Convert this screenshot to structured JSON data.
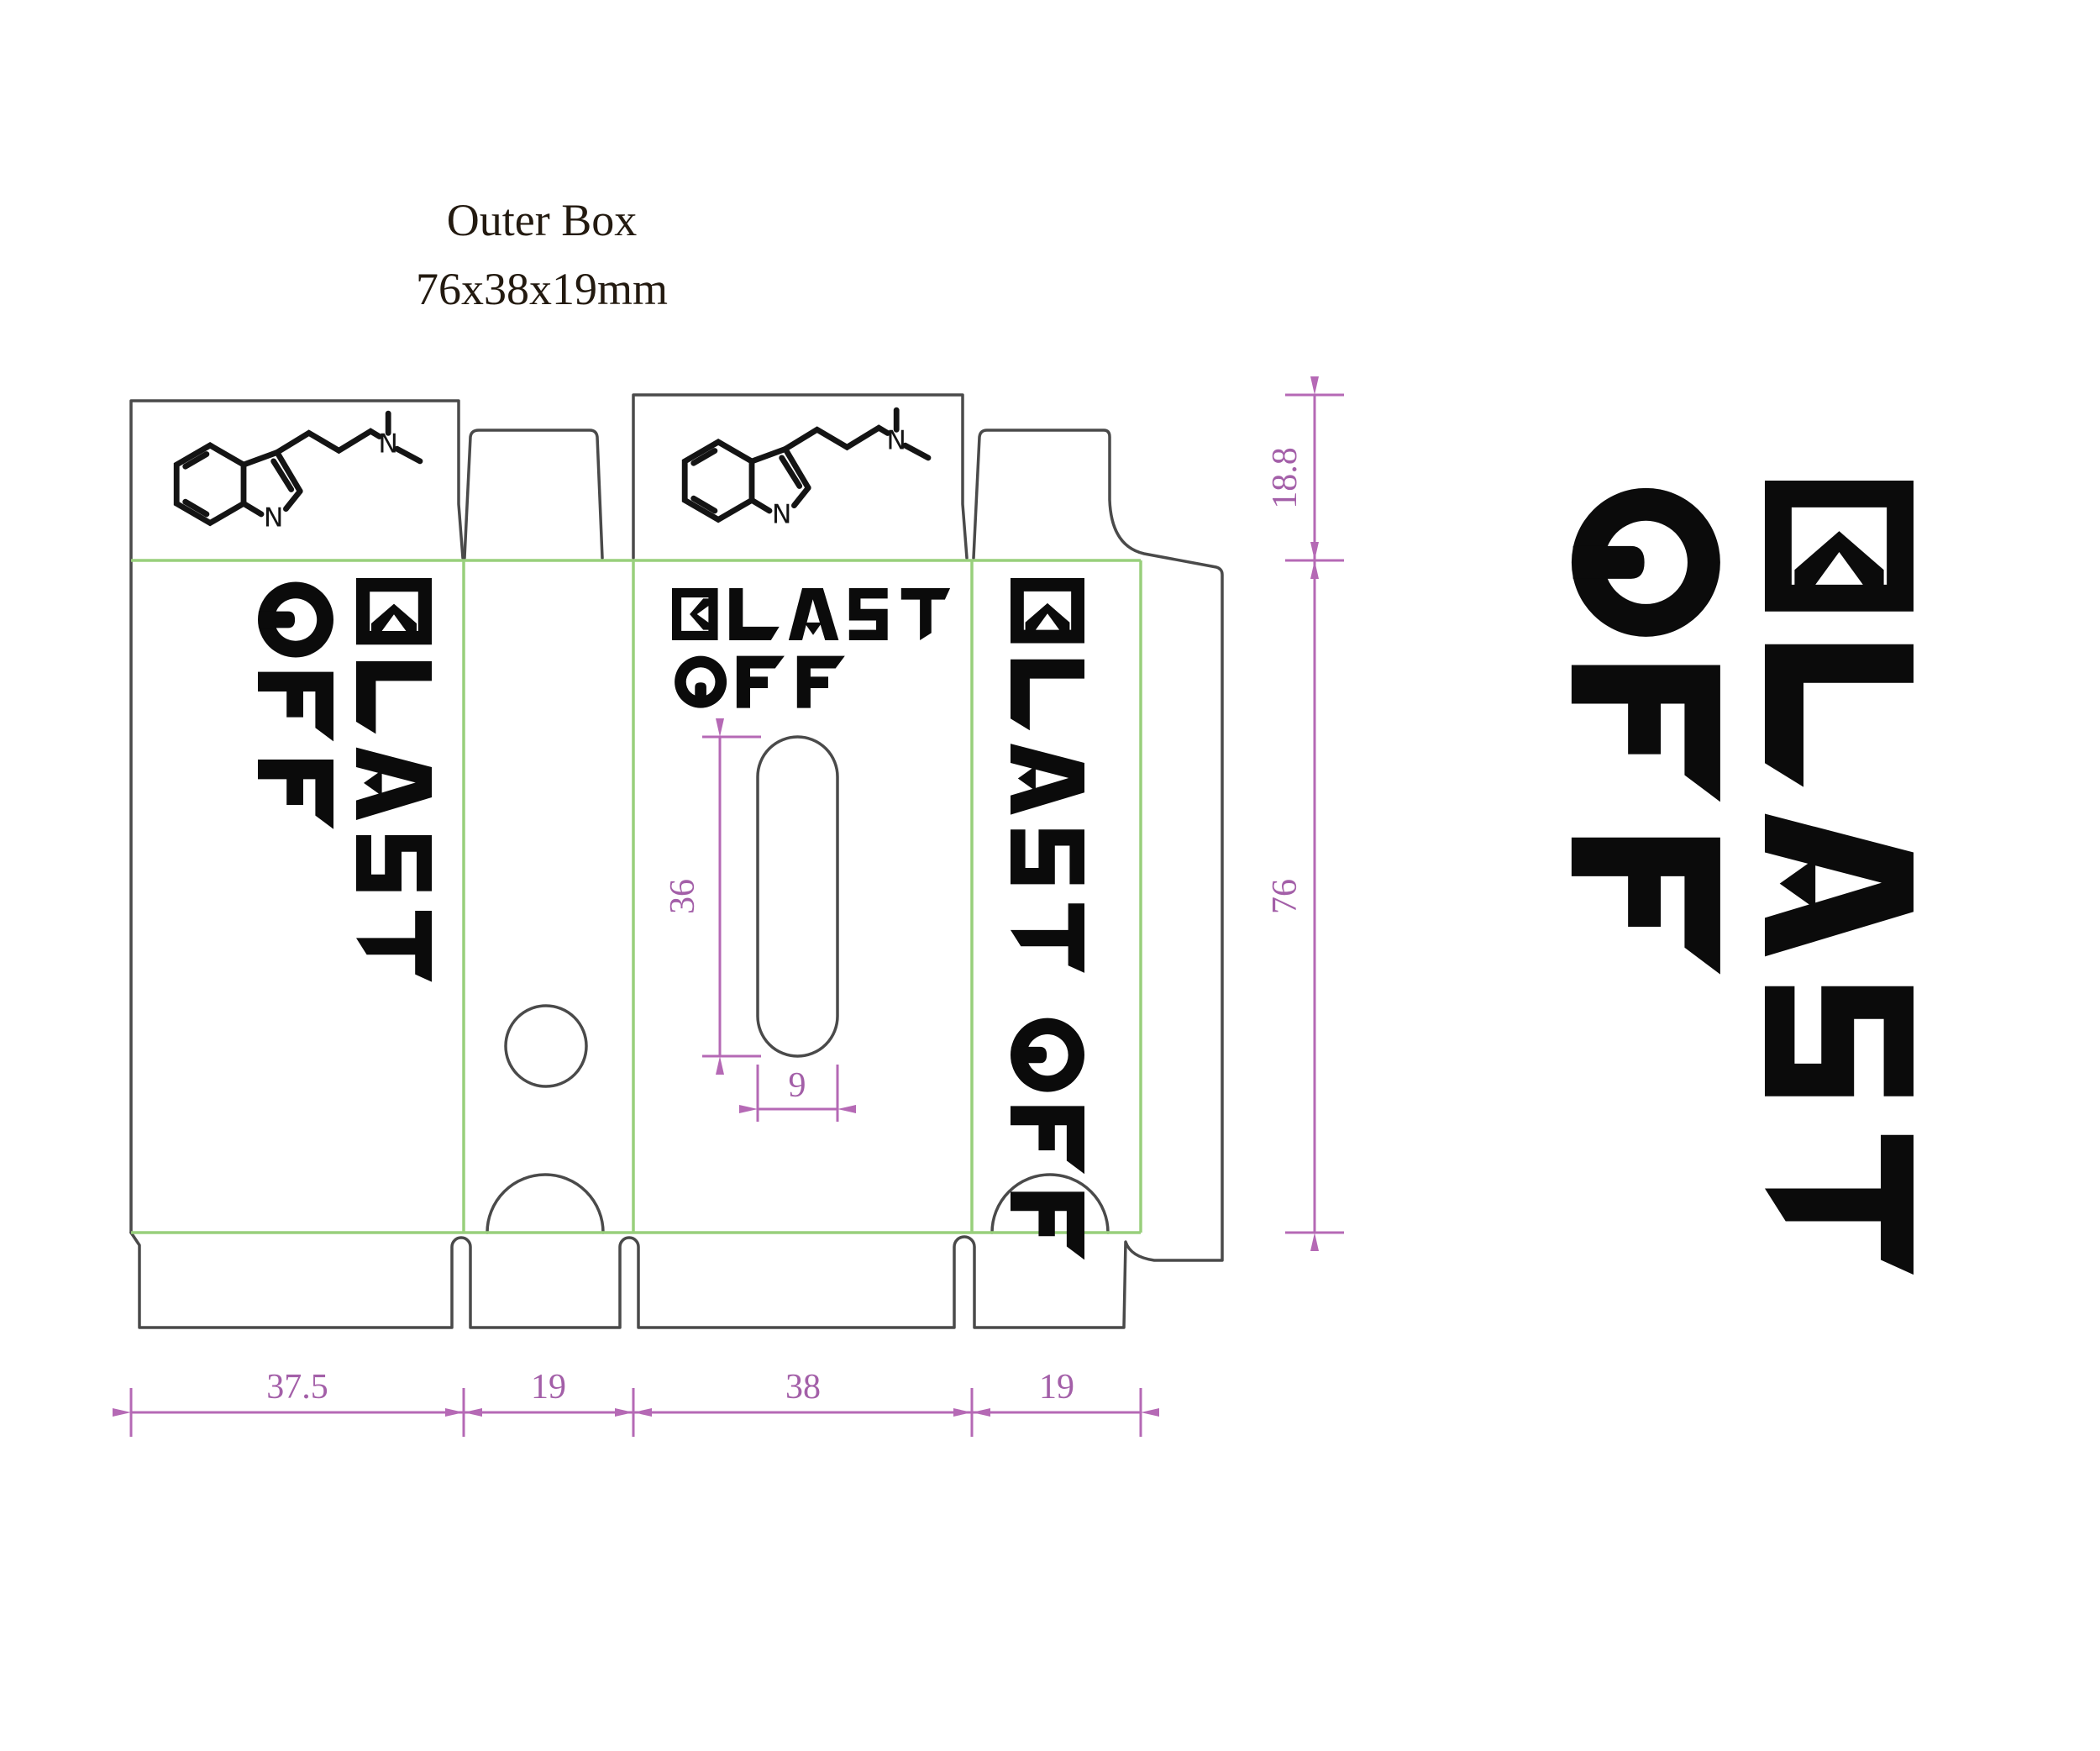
{
  "title": {
    "line1": "Outer Box",
    "line2": "76x38x19mm"
  },
  "dimensions": {
    "flap_height": "18.8",
    "body_height": "76",
    "panel_widths": [
      "37.5",
      "19",
      "38",
      "19"
    ],
    "window_height": "36",
    "window_width": "9"
  },
  "logo": {
    "full_text": "BLAST OFF",
    "line1": "BLAST",
    "line2": "OFF"
  },
  "molecule": {
    "nitrogen_label": "N"
  },
  "colors": {
    "fold_line": "#98cf7c",
    "cut_line": "#4a4a4a",
    "dimension_line": "#b569b5",
    "dimension_text": "#a35fa8",
    "ink": "#0b0b0b"
  }
}
